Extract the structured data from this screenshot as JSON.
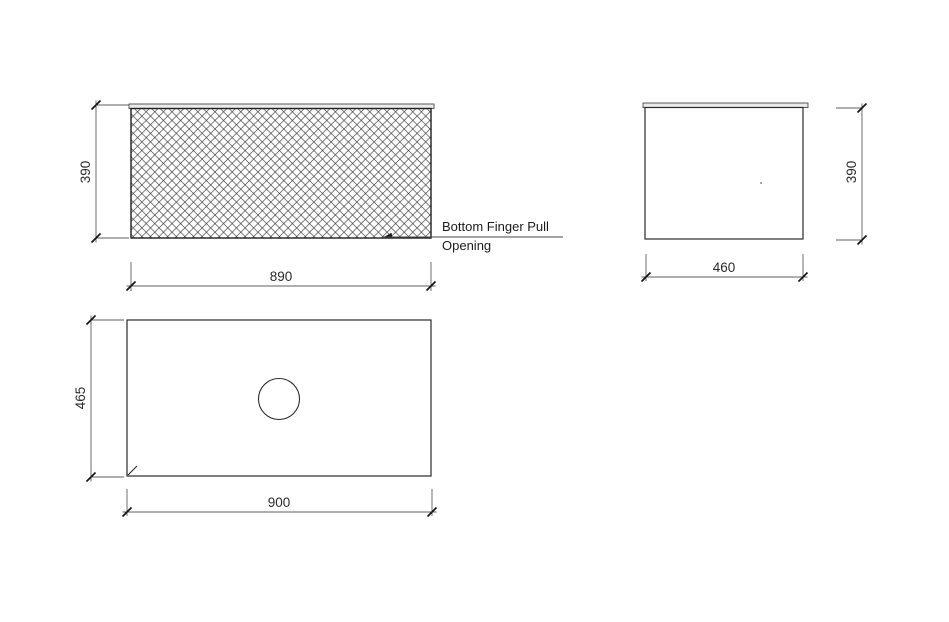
{
  "annotation": {
    "line1": "Bottom Finger Pull",
    "line2": "Opening"
  },
  "dimensions": {
    "front_height": "390",
    "front_width": "890",
    "side_depth": "460",
    "side_height": "390",
    "plan_depth": "465",
    "plan_width": "900"
  },
  "colors": {
    "background": "#ffffff",
    "object_line": "#2a2a2a",
    "dimension_line": "#5f5f5f",
    "hatch_line": "#3a3a3a",
    "countertop_fill": "#ebebeb",
    "text": "#2b2b2b"
  }
}
